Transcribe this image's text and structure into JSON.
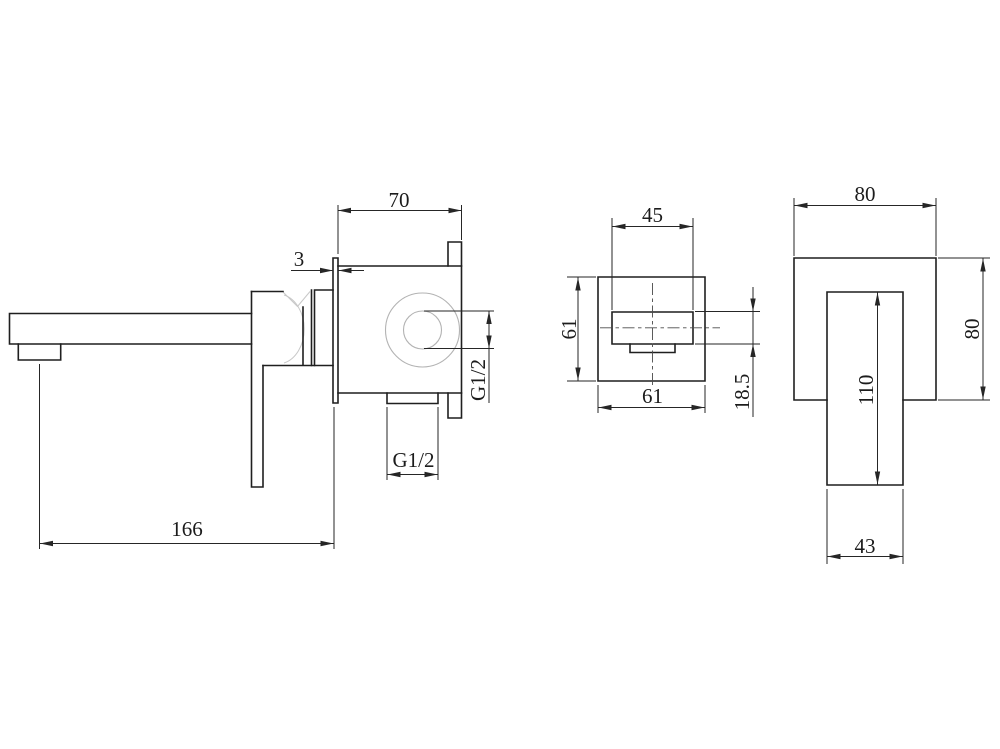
{
  "page": {
    "background": "#ffffff"
  },
  "drawing": {
    "type": "technical-dimension-drawing",
    "subject": "wall-mounted basin mixer tap, three orthographic views",
    "colors": {
      "line": "#1f1f1f",
      "dimension": "#262626",
      "construction": "#b3b3b3"
    },
    "views": {
      "side": {
        "name": "side view (spout and concealed valve body)",
        "dims": {
          "body_depth": "70",
          "plate_thickness": "3",
          "outlet_thread": "G1/2",
          "inlet_thread": "G1/2",
          "spout_reach": "166"
        }
      },
      "valve_front": {
        "name": "valve body front view",
        "dims": {
          "slot_width": "45",
          "plate_height": "61",
          "plate_width": "61",
          "slot_height": "18.5"
        }
      },
      "handle_front": {
        "name": "handle escutcheon front view",
        "dims": {
          "plate_width": "80",
          "plate_height": "80",
          "lever_length": "110",
          "lever_width": "43"
        }
      }
    }
  }
}
